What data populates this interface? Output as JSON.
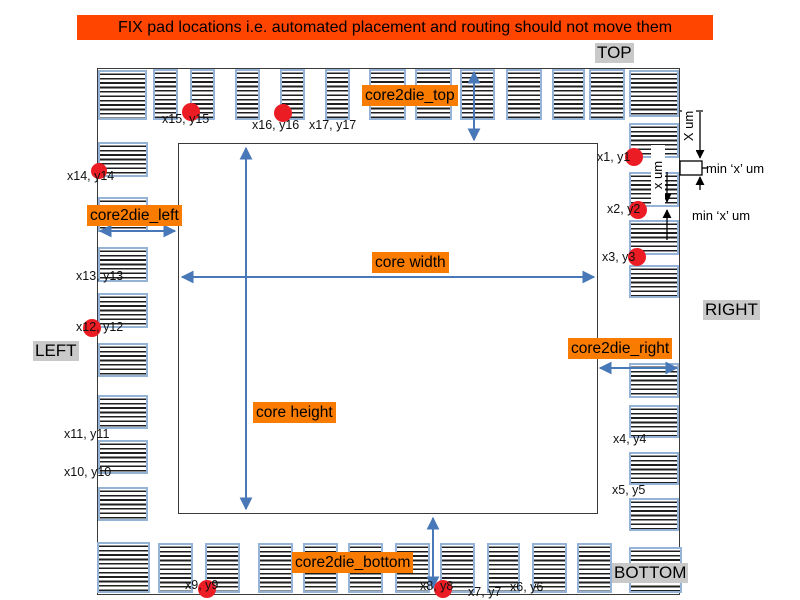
{
  "banner": {
    "text": "FIX pad locations i.e. automated placement and routing should not move them",
    "bg": "#FF4500",
    "x": 77,
    "y": 15,
    "w": 636,
    "h": 25
  },
  "colors": {
    "banner_red": "#FF4500",
    "label_orange": "#F97C00",
    "label_gray": "#C9C9C9",
    "arrow_blue": "#4878B8",
    "pad_border_blue": "#95B3D7",
    "pad_stripe_dark": "#1F1F1F",
    "fix_marker_red": "#EC1C24",
    "outline_dark": "#3A3A3A"
  },
  "die_outline": {
    "x": 97,
    "y": 68,
    "w": 583,
    "h": 527
  },
  "core_outline": {
    "x": 178,
    "y": 143,
    "w": 420,
    "h": 371
  },
  "side_labels": [
    {
      "id": "top",
      "text": "TOP",
      "x": 595,
      "y": 43
    },
    {
      "id": "right",
      "text": "RIGHT",
      "x": 703,
      "y": 300
    },
    {
      "id": "left",
      "text": "LEFT",
      "x": 33,
      "y": 341
    },
    {
      "id": "bottom",
      "text": "BOTTOM",
      "x": 612,
      "y": 563
    }
  ],
  "region_labels": [
    {
      "id": "core2die-top",
      "text": "core2die_top",
      "x": 362,
      "y": 85
    },
    {
      "id": "core2die-left",
      "text": "core2die_left",
      "x": 87,
      "y": 205
    },
    {
      "id": "core2die-right",
      "text": "core2die_right",
      "x": 568,
      "y": 338
    },
    {
      "id": "core2die-bottom",
      "text": "core2die_bottom",
      "x": 292,
      "y": 552
    },
    {
      "id": "core-width",
      "text": "core width",
      "x": 372,
      "y": 252
    },
    {
      "id": "core-height",
      "text": "core height",
      "x": 253,
      "y": 402
    }
  ],
  "pad_coord_labels": [
    {
      "text": "x1, y1",
      "x": 597,
      "y": 151
    },
    {
      "text": "x2, y2",
      "x": 607,
      "y": 203
    },
    {
      "text": "x3, y3",
      "x": 602,
      "y": 251
    },
    {
      "text": "x4, y4",
      "x": 613,
      "y": 433
    },
    {
      "text": "x5, y5",
      "x": 612,
      "y": 484
    },
    {
      "text": "x6, y6",
      "x": 510,
      "y": 581
    },
    {
      "text": "x7, y7",
      "x": 468,
      "y": 586
    },
    {
      "text": "x8, y8",
      "x": 420,
      "y": 580
    },
    {
      "text": "x9, y9",
      "x": 185,
      "y": 579
    },
    {
      "text": "x10, y10",
      "x": 64,
      "y": 466
    },
    {
      "text": "x11, y11",
      "x": 64,
      "y": 428
    },
    {
      "text": "x12, y12",
      "x": 76,
      "y": 321
    },
    {
      "text": "x13, y13",
      "x": 76,
      "y": 270
    },
    {
      "text": "x14, y14",
      "x": 67,
      "y": 170
    },
    {
      "text": "x15, y15",
      "x": 162,
      "y": 113
    },
    {
      "text": "x16, y16",
      "x": 252,
      "y": 119
    },
    {
      "text": "x17, y17",
      "x": 309,
      "y": 119
    }
  ],
  "fix_pad_markers": [
    {
      "marks": "x15, y15",
      "cx": 191,
      "cy": 112,
      "r": 9
    },
    {
      "marks": "x16, y16",
      "cx": 283,
      "cy": 113,
      "r": 9
    },
    {
      "marks": "x1, y1",
      "cx": 634,
      "cy": 157,
      "r": 9
    },
    {
      "marks": "x2, y2",
      "cx": 638,
      "cy": 210,
      "r": 9
    },
    {
      "marks": "x3, y3",
      "cx": 637,
      "cy": 257,
      "r": 9
    },
    {
      "marks": "x14, y14",
      "cx": 99,
      "cy": 171,
      "r": 8
    },
    {
      "marks": "x12, y12",
      "cx": 92,
      "cy": 328,
      "r": 9
    },
    {
      "marks": "x9, y9",
      "cx": 207,
      "cy": 589,
      "r": 9
    },
    {
      "marks": "x8, y8",
      "cx": 443,
      "cy": 589,
      "r": 9
    }
  ],
  "pads": {
    "top": [
      [
        153,
        69,
        25,
        51
      ],
      [
        190,
        69,
        25,
        51
      ],
      [
        235,
        69,
        25,
        51
      ],
      [
        280,
        69,
        25,
        51
      ],
      [
        325,
        69,
        25,
        51
      ],
      [
        369,
        69,
        37,
        51
      ],
      [
        415,
        69,
        37,
        51
      ],
      [
        460,
        69,
        35,
        51
      ],
      [
        506,
        69,
        36,
        51
      ],
      [
        552,
        69,
        33,
        51
      ],
      [
        589,
        69,
        36,
        51
      ]
    ],
    "bottom": [
      [
        158,
        543,
        35,
        50
      ],
      [
        205,
        543,
        35,
        50
      ],
      [
        258,
        543,
        35,
        50
      ],
      [
        303,
        543,
        35,
        50
      ],
      [
        348,
        543,
        35,
        50
      ],
      [
        395,
        543,
        35,
        50
      ],
      [
        440,
        543,
        35,
        50
      ],
      [
        487,
        543,
        33,
        50
      ],
      [
        532,
        543,
        35,
        50
      ],
      [
        577,
        543,
        35,
        50
      ]
    ],
    "left": [
      [
        98,
        142,
        50,
        35
      ],
      [
        98,
        197,
        50,
        35
      ],
      [
        98,
        247,
        50,
        35
      ],
      [
        98,
        293,
        50,
        35
      ],
      [
        98,
        343,
        50,
        34
      ],
      [
        98,
        395,
        50,
        34
      ],
      [
        98,
        440,
        50,
        34
      ],
      [
        98,
        487,
        50,
        34
      ]
    ],
    "right": [
      [
        629,
        123,
        50,
        35
      ],
      [
        629,
        172,
        50,
        35
      ],
      [
        629,
        220,
        50,
        35
      ],
      [
        629,
        265,
        50,
        33
      ],
      [
        629,
        363,
        50,
        35
      ],
      [
        629,
        405,
        50,
        33
      ],
      [
        629,
        452,
        50,
        33
      ],
      [
        629,
        498,
        50,
        33
      ]
    ],
    "corner": [
      [
        98,
        70,
        49,
        50
      ],
      [
        629,
        70,
        50,
        47
      ],
      [
        97,
        542,
        53,
        51
      ],
      [
        629,
        547,
        53,
        46
      ]
    ]
  },
  "dimension_arrows": [
    {
      "id": "core-width-arrow",
      "x1": 182,
      "y1": 277,
      "x2": 594,
      "y2": 277
    },
    {
      "id": "core-height-arrow",
      "x1": 246,
      "y1": 148,
      "x2": 246,
      "y2": 509
    },
    {
      "id": "core2die-top-arrow",
      "x1": 474,
      "y1": 72,
      "x2": 474,
      "y2": 140
    },
    {
      "id": "core2die-bottom-arrow",
      "x1": 433,
      "y1": 518,
      "x2": 433,
      "y2": 588
    },
    {
      "id": "core2die-left-arrow",
      "x1": 100,
      "y1": 231,
      "x2": 175,
      "y2": 231
    },
    {
      "id": "core2die-right-arrow",
      "x1": 600,
      "y1": 368,
      "x2": 677,
      "y2": 368
    }
  ],
  "spacing_annotations": {
    "texts": [
      {
        "text": "X um",
        "cx": 689,
        "cy": 126,
        "rot": true
      },
      {
        "text": "x um",
        "cx": 658,
        "cy": 175,
        "rot": true
      },
      {
        "text": "min ‘x’ um",
        "x": 706,
        "y": 162
      },
      {
        "text": "min ‘x’ um",
        "x": 692,
        "y": 209
      }
    ],
    "lines": [
      {
        "id": "tick-top",
        "x1": 680,
        "y1": 111,
        "x2": 703,
        "y2": 111,
        "end": false
      },
      {
        "id": "x-um-arrow",
        "x1": 700,
        "y1": 112,
        "x2": 700,
        "y2": 158,
        "end": true
      },
      {
        "id": "min-x-up-arrow",
        "x1": 700,
        "y1": 190,
        "x2": 700,
        "y2": 177,
        "end": true
      },
      {
        "id": "min-x-leader",
        "x1": 702,
        "y1": 168,
        "x2": 708,
        "y2": 168,
        "end": false
      },
      {
        "id": "gap-down-arrow",
        "x1": 667,
        "y1": 172,
        "x2": 667,
        "y2": 202,
        "end": true
      },
      {
        "id": "gap-up-arrow",
        "x1": 667,
        "y1": 240,
        "x2": 667,
        "y2": 210,
        "end": true
      }
    ],
    "gap_box": {
      "x": 680,
      "y": 161,
      "w": 22,
      "h": 14
    }
  }
}
